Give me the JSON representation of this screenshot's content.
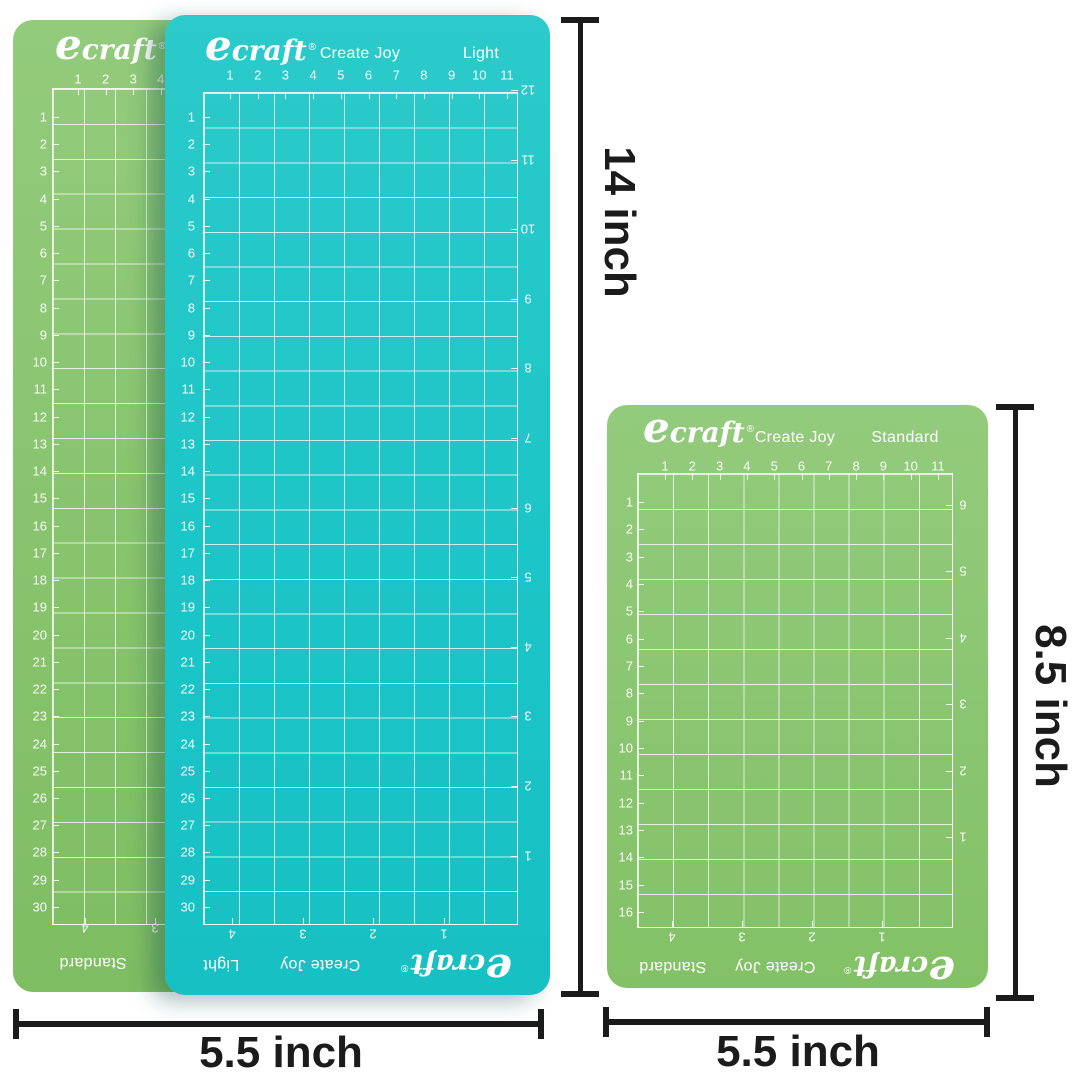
{
  "colors": {
    "teal_mat": "#1fc5c7",
    "green_mat": "#8bc873",
    "grid_line": "#ffffff",
    "mat_text": "#ffffff",
    "dimension_ink": "#1b1b1b",
    "background": "#ffffff"
  },
  "mats": {
    "back_green": {
      "brand_initial": "e",
      "brand_rest": "craft",
      "registered": "®",
      "footer_type": "Standard",
      "top_numbers": [
        "1",
        "2",
        "3",
        "4"
      ],
      "left_numbers": [
        "1",
        "2",
        "3",
        "4",
        "5",
        "6",
        "7",
        "8",
        "9",
        "10",
        "11",
        "12",
        "13",
        "14",
        "15",
        "16",
        "17",
        "18",
        "19",
        "20",
        "21",
        "22",
        "23",
        "24",
        "25",
        "26",
        "27",
        "28",
        "29",
        "30"
      ],
      "bottom_numbers": [
        "4",
        "3"
      ]
    },
    "front_teal": {
      "brand_initial": "e",
      "brand_rest": "craft",
      "registered": "®",
      "tagline": "Create Joy",
      "type": "Light",
      "top_numbers": [
        "1",
        "2",
        "3",
        "4",
        "5",
        "6",
        "7",
        "8",
        "9",
        "10",
        "11"
      ],
      "left_numbers": [
        "1",
        "2",
        "3",
        "4",
        "5",
        "6",
        "7",
        "8",
        "9",
        "10",
        "11",
        "12",
        "13",
        "14",
        "15",
        "16",
        "17",
        "18",
        "19",
        "20",
        "21",
        "22",
        "23",
        "24",
        "25",
        "26",
        "27",
        "28",
        "29",
        "30"
      ],
      "right_numbers": [
        "12",
        "11",
        "10",
        "9",
        "8",
        "7",
        "6",
        "5",
        "4",
        "3",
        "2",
        "1"
      ],
      "bottom_numbers": [
        "4",
        "3",
        "2",
        "1"
      ]
    },
    "right_green": {
      "brand_initial": "e",
      "brand_rest": "craft",
      "registered": "®",
      "tagline": "Create Joy",
      "type": "Standard",
      "top_numbers": [
        "1",
        "2",
        "3",
        "4",
        "5",
        "6",
        "7",
        "8",
        "9",
        "10",
        "11"
      ],
      "left_numbers": [
        "1",
        "2",
        "3",
        "4",
        "5",
        "6",
        "7",
        "8",
        "9",
        "10",
        "11",
        "12",
        "13",
        "14",
        "15",
        "16"
      ],
      "right_numbers": [
        "6",
        "5",
        "4",
        "3",
        "2",
        "1"
      ],
      "bottom_numbers": [
        "4",
        "3",
        "2",
        "1"
      ]
    }
  },
  "dimensions": {
    "front_mat_height": "14 inch",
    "front_mat_width": "5.5 inch",
    "right_mat_height": "8.5 inch",
    "right_mat_width": "5.5 inch"
  }
}
